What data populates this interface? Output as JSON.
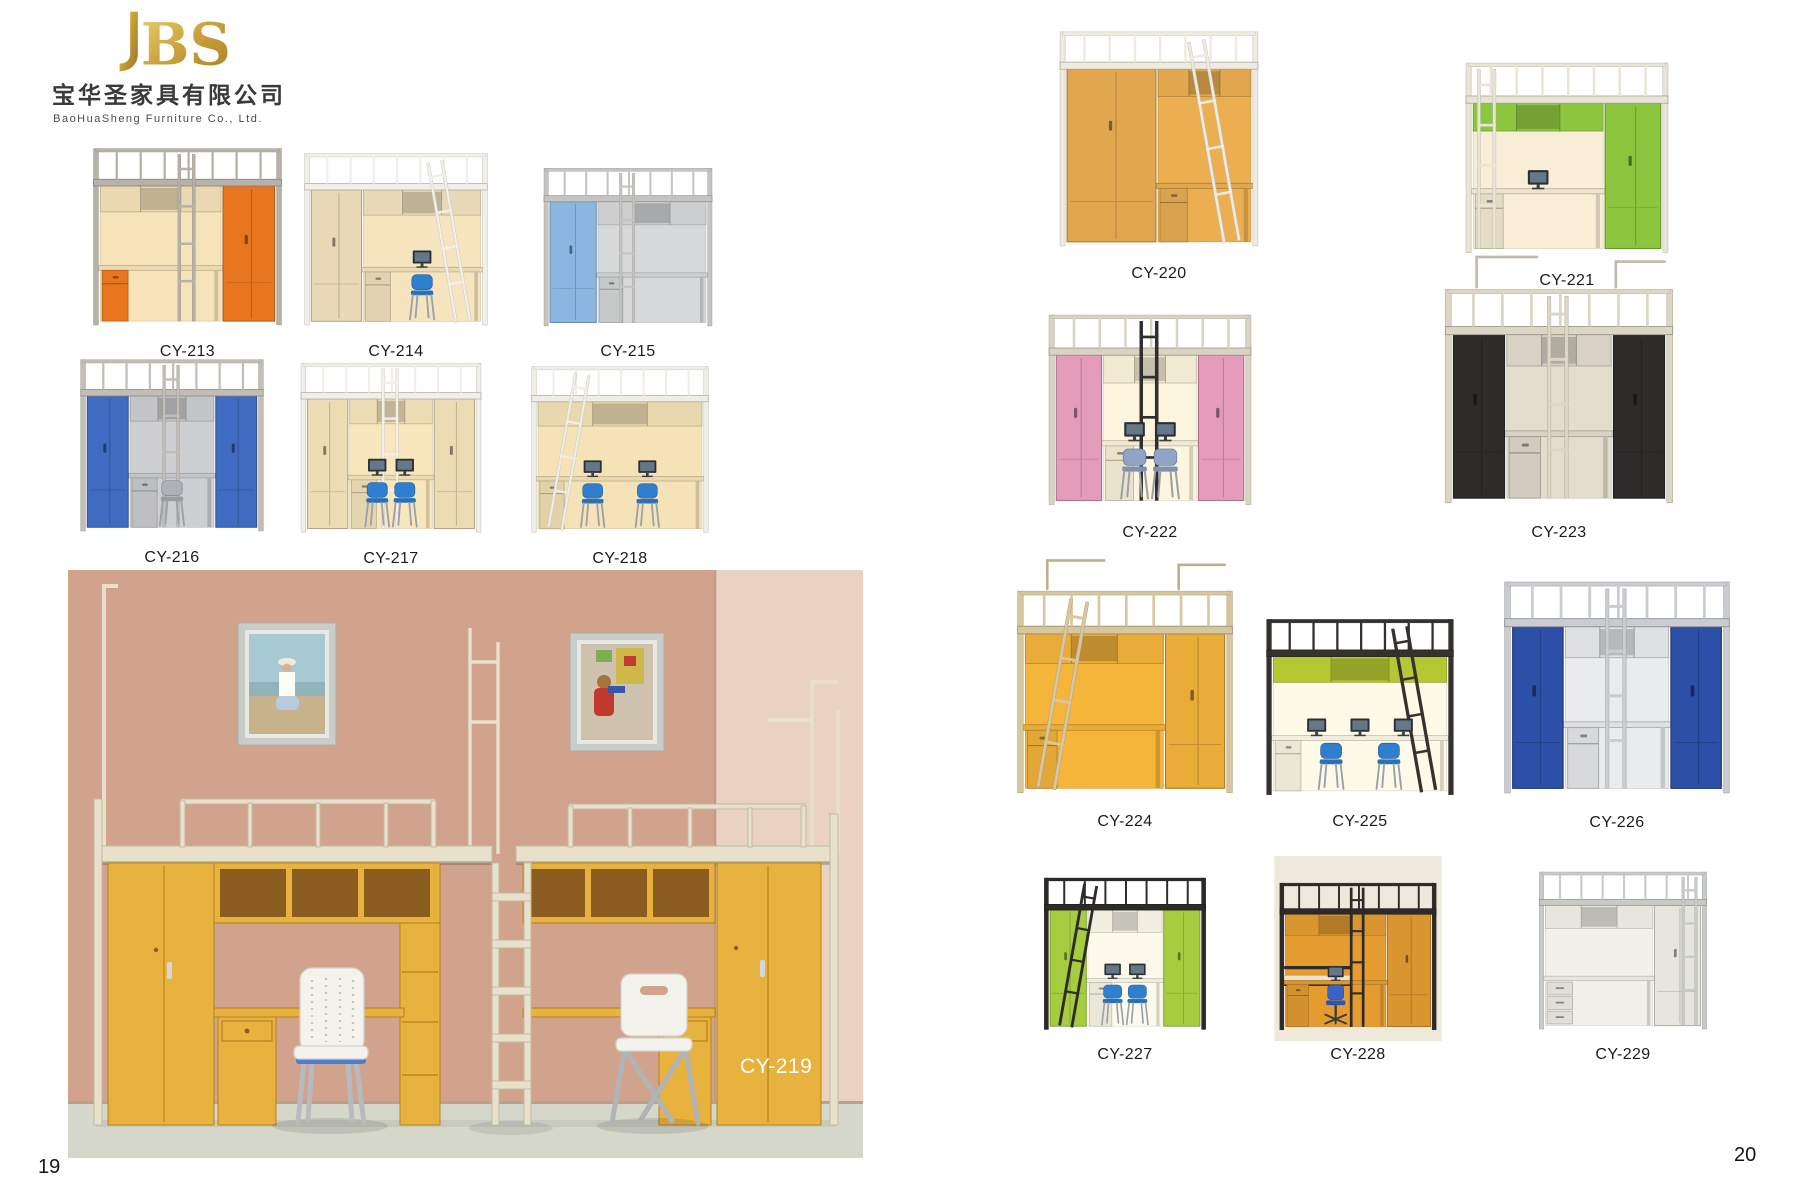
{
  "logo": {
    "monogram": "BS",
    "company_cn": "宝华圣家具有限公司",
    "company_en": "BaoHuaSheng Furniture Co., Ltd.",
    "gold": [
      "#e9d273",
      "#caa13b",
      "#a6802c"
    ]
  },
  "pages": {
    "left_number": "19",
    "right_number": "20"
  },
  "photo_product": {
    "code": "CY-219",
    "label_color": "#ffffff",
    "colors": {
      "wall": "#d1a28c",
      "wall_light": "#ead2c0",
      "floor": "#d6d7cb",
      "wood": "#e8b23f",
      "wood_dark": "#8a5c20",
      "metal": "#e7e1cc",
      "chair": "#f4f2ec",
      "chair_seat": "#4a7fd4",
      "frame": "#c9cdc9"
    }
  },
  "products": [
    {
      "code": "CY-213",
      "visual": {
        "frame": "#b7b2a8",
        "wood": "#ead8b0",
        "accent": "#e8761e",
        "wardrobe": "right",
        "ladder": "center",
        "pedAccent": true
      }
    },
    {
      "code": "CY-214",
      "visual": {
        "frame": "#f2efe8",
        "wood": "#ead9b6",
        "accent": "#ead9b6",
        "wardrobe": "left",
        "ladder": "diagRight",
        "monitors": 1,
        "chairs": 1,
        "chairColor": "#2f7fd1"
      }
    },
    {
      "code": "CY-215",
      "visual": {
        "frame": "#c6c4c0",
        "wood": "#ccced0",
        "accent": "#8ab6e0",
        "wardrobe": "left",
        "ladder": "center"
      }
    },
    {
      "code": "CY-216",
      "visual": {
        "frame": "#c2beb6",
        "wood": "#c3c5c9",
        "accent": "#3f6cc0",
        "wardrobe": "both",
        "ladder": "center",
        "chairs": 1,
        "chairColor": "#aeb2b8"
      }
    },
    {
      "code": "CY-217",
      "visual": {
        "frame": "#f2efe8",
        "wood": "#ecdcb4",
        "accent": "#ecdcb4",
        "wardrobe": "both",
        "wardrobeColor": "#ecdcb4",
        "ladder": "center",
        "monitors": 2,
        "chairs": 2,
        "chairColor": "#2f7fd1"
      }
    },
    {
      "code": "CY-218",
      "visual": {
        "frame": "#f0ede6",
        "wood": "#e9d8ae",
        "wardrobe": "none",
        "ladder": "diagLeft",
        "monitors": 2,
        "chairs": 2,
        "chairColor": "#2f7fd1"
      }
    },
    {
      "code": "CY-220",
      "visual": {
        "frame": "#efebe0",
        "wood": "#e0a74e",
        "wardrobe": "left",
        "wardrobeColor": "#e0a74e",
        "wideWardrobe": true,
        "tall": true,
        "ladder": "diagRight"
      }
    },
    {
      "code": "CY-221",
      "visual": {
        "frame": "#e9e5d6",
        "wood": "#ece3cc",
        "accent": "#8cc63e",
        "topBand": "#8cc63e",
        "wardrobe": "right",
        "ladder": "left",
        "monitors": 1
      }
    },
    {
      "code": "CY-222",
      "visual": {
        "frame": "#d9d3c2",
        "wood": "#f1e9d2",
        "accent": "#e59cba",
        "wardrobe": "both",
        "ladder": "center",
        "ladderColor": "#2e2e2e",
        "monitors": 2,
        "chairs": 2,
        "chairColor": "#8fa5c8"
      }
    },
    {
      "code": "CY-223",
      "visual": {
        "frame": "#ddd6c4",
        "wood": "#d8d2c4",
        "accent": "#2d2c2a",
        "wardrobe": "both",
        "poles": true,
        "ladder": "center"
      }
    },
    {
      "code": "CY-224",
      "visual": {
        "frame": "#d8c79e",
        "wood": "#e9ac38",
        "accent": "#e9ac38",
        "wardrobe": "right",
        "wardrobeColor": "#e9ac38",
        "poles": true,
        "ladder": "diagLeft"
      }
    },
    {
      "code": "CY-225",
      "visual": {
        "frame": "#35322e",
        "wood": "#f2eedc",
        "accent": "#b3c832",
        "topBand": "#b3c832",
        "wardrobe": "none",
        "ladder": "diagRight",
        "ladderColor": "#35322e",
        "monitors": 3,
        "chairs": 2,
        "chairColor": "#2f7fd1"
      }
    },
    {
      "code": "CY-226",
      "visual": {
        "frame": "#c9ccd1",
        "wood": "#dfe0e2",
        "accent": "#2c4fa8",
        "wardrobe": "both",
        "ladder": "center"
      }
    },
    {
      "code": "CY-227",
      "visual": {
        "frame": "#2d2b28",
        "wood": "#f1eee0",
        "accent": "#a6cc3f",
        "wardrobe": "both",
        "ladder": "diagLeft",
        "ladderColor": "#2d2b28",
        "monitors": 2,
        "chairs": 2,
        "chairColor": "#2f80d0"
      }
    },
    {
      "code": "CY-228",
      "visual": {
        "frame": "#2d2b28",
        "wood": "#d9952f",
        "accent": "#d9952f",
        "wardrobe": "right",
        "bg": "#efe9dc",
        "ladder": "center",
        "ladderColor": "#2d2b28",
        "monitors": 1,
        "chairs": 1,
        "chairColor": "#3a62c9",
        "swivel": true,
        "lowerBed": true
      }
    },
    {
      "code": "CY-229",
      "visual": {
        "frame": "#c7cac7",
        "wood": "#e7e5dc",
        "accent": "#e7e5dc",
        "wardrobe": "right",
        "ladder": "right",
        "drawers": true
      }
    }
  ]
}
